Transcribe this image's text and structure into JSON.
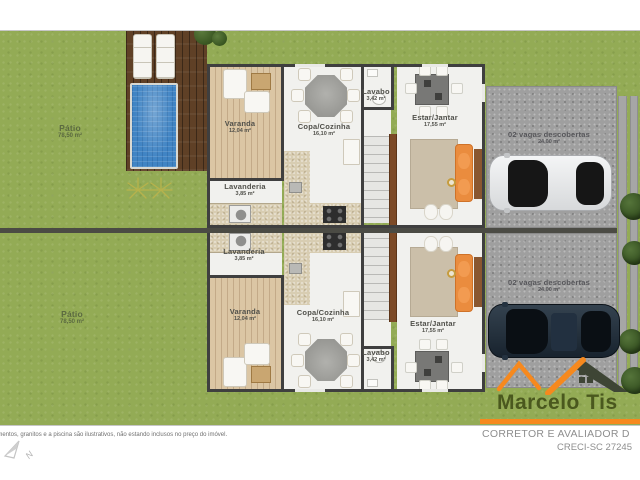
{
  "plan": {
    "patio_top": {
      "name": "Pátio",
      "area": "78,50 m²"
    },
    "patio_bottom": {
      "name": "Pátio",
      "area": "78,50 m²"
    },
    "unit_top": {
      "varanda": {
        "name": "Varanda",
        "area": "12,04 m²"
      },
      "lavanderia": {
        "name": "Lavanderia",
        "area": "3,85 m²"
      },
      "copa_cozinha": {
        "name": "Copa/Cozinha",
        "area": "16,10 m²"
      },
      "lavabo": {
        "name": "Lavabo",
        "area": "3,42 m²"
      },
      "estar_jantar": {
        "name": "Estar/Jantar",
        "area": "17,55 m²"
      }
    },
    "unit_bottom": {
      "varanda": {
        "name": "Varanda",
        "area": "12,04 m²"
      },
      "lavanderia": {
        "name": "Lavanderia",
        "area": "3,85 m²"
      },
      "copa_cozinha": {
        "name": "Copa/Cozinha",
        "area": "16,10 m²"
      },
      "lavabo": {
        "name": "Lavabo",
        "area": "3,42 m²"
      },
      "estar_jantar": {
        "name": "Estar/Jantar",
        "area": "17,55 m²"
      }
    },
    "parking_top": {
      "name": "02 vagas descobertas",
      "area": "24,00 m²"
    },
    "parking_bottom": {
      "name": "02 vagas descobertas",
      "area": "24,00 m²"
    }
  },
  "footer": {
    "disclaimer": "amentos, granitos e a piscina são ilustrativos, não estando inclusos no preço do imóvel.",
    "north_label": "N"
  },
  "branding": {
    "name": "Marcelo Tis",
    "subtitle": "CORRETOR E AVALIADOR D",
    "license": "CRECI-SC 27245",
    "accent_color": "#f6891e",
    "name_color": "#4a581e",
    "subtitle_color": "#8e8e8e",
    "grass_color": "#93ab55",
    "pool_color": "#4084c4"
  }
}
